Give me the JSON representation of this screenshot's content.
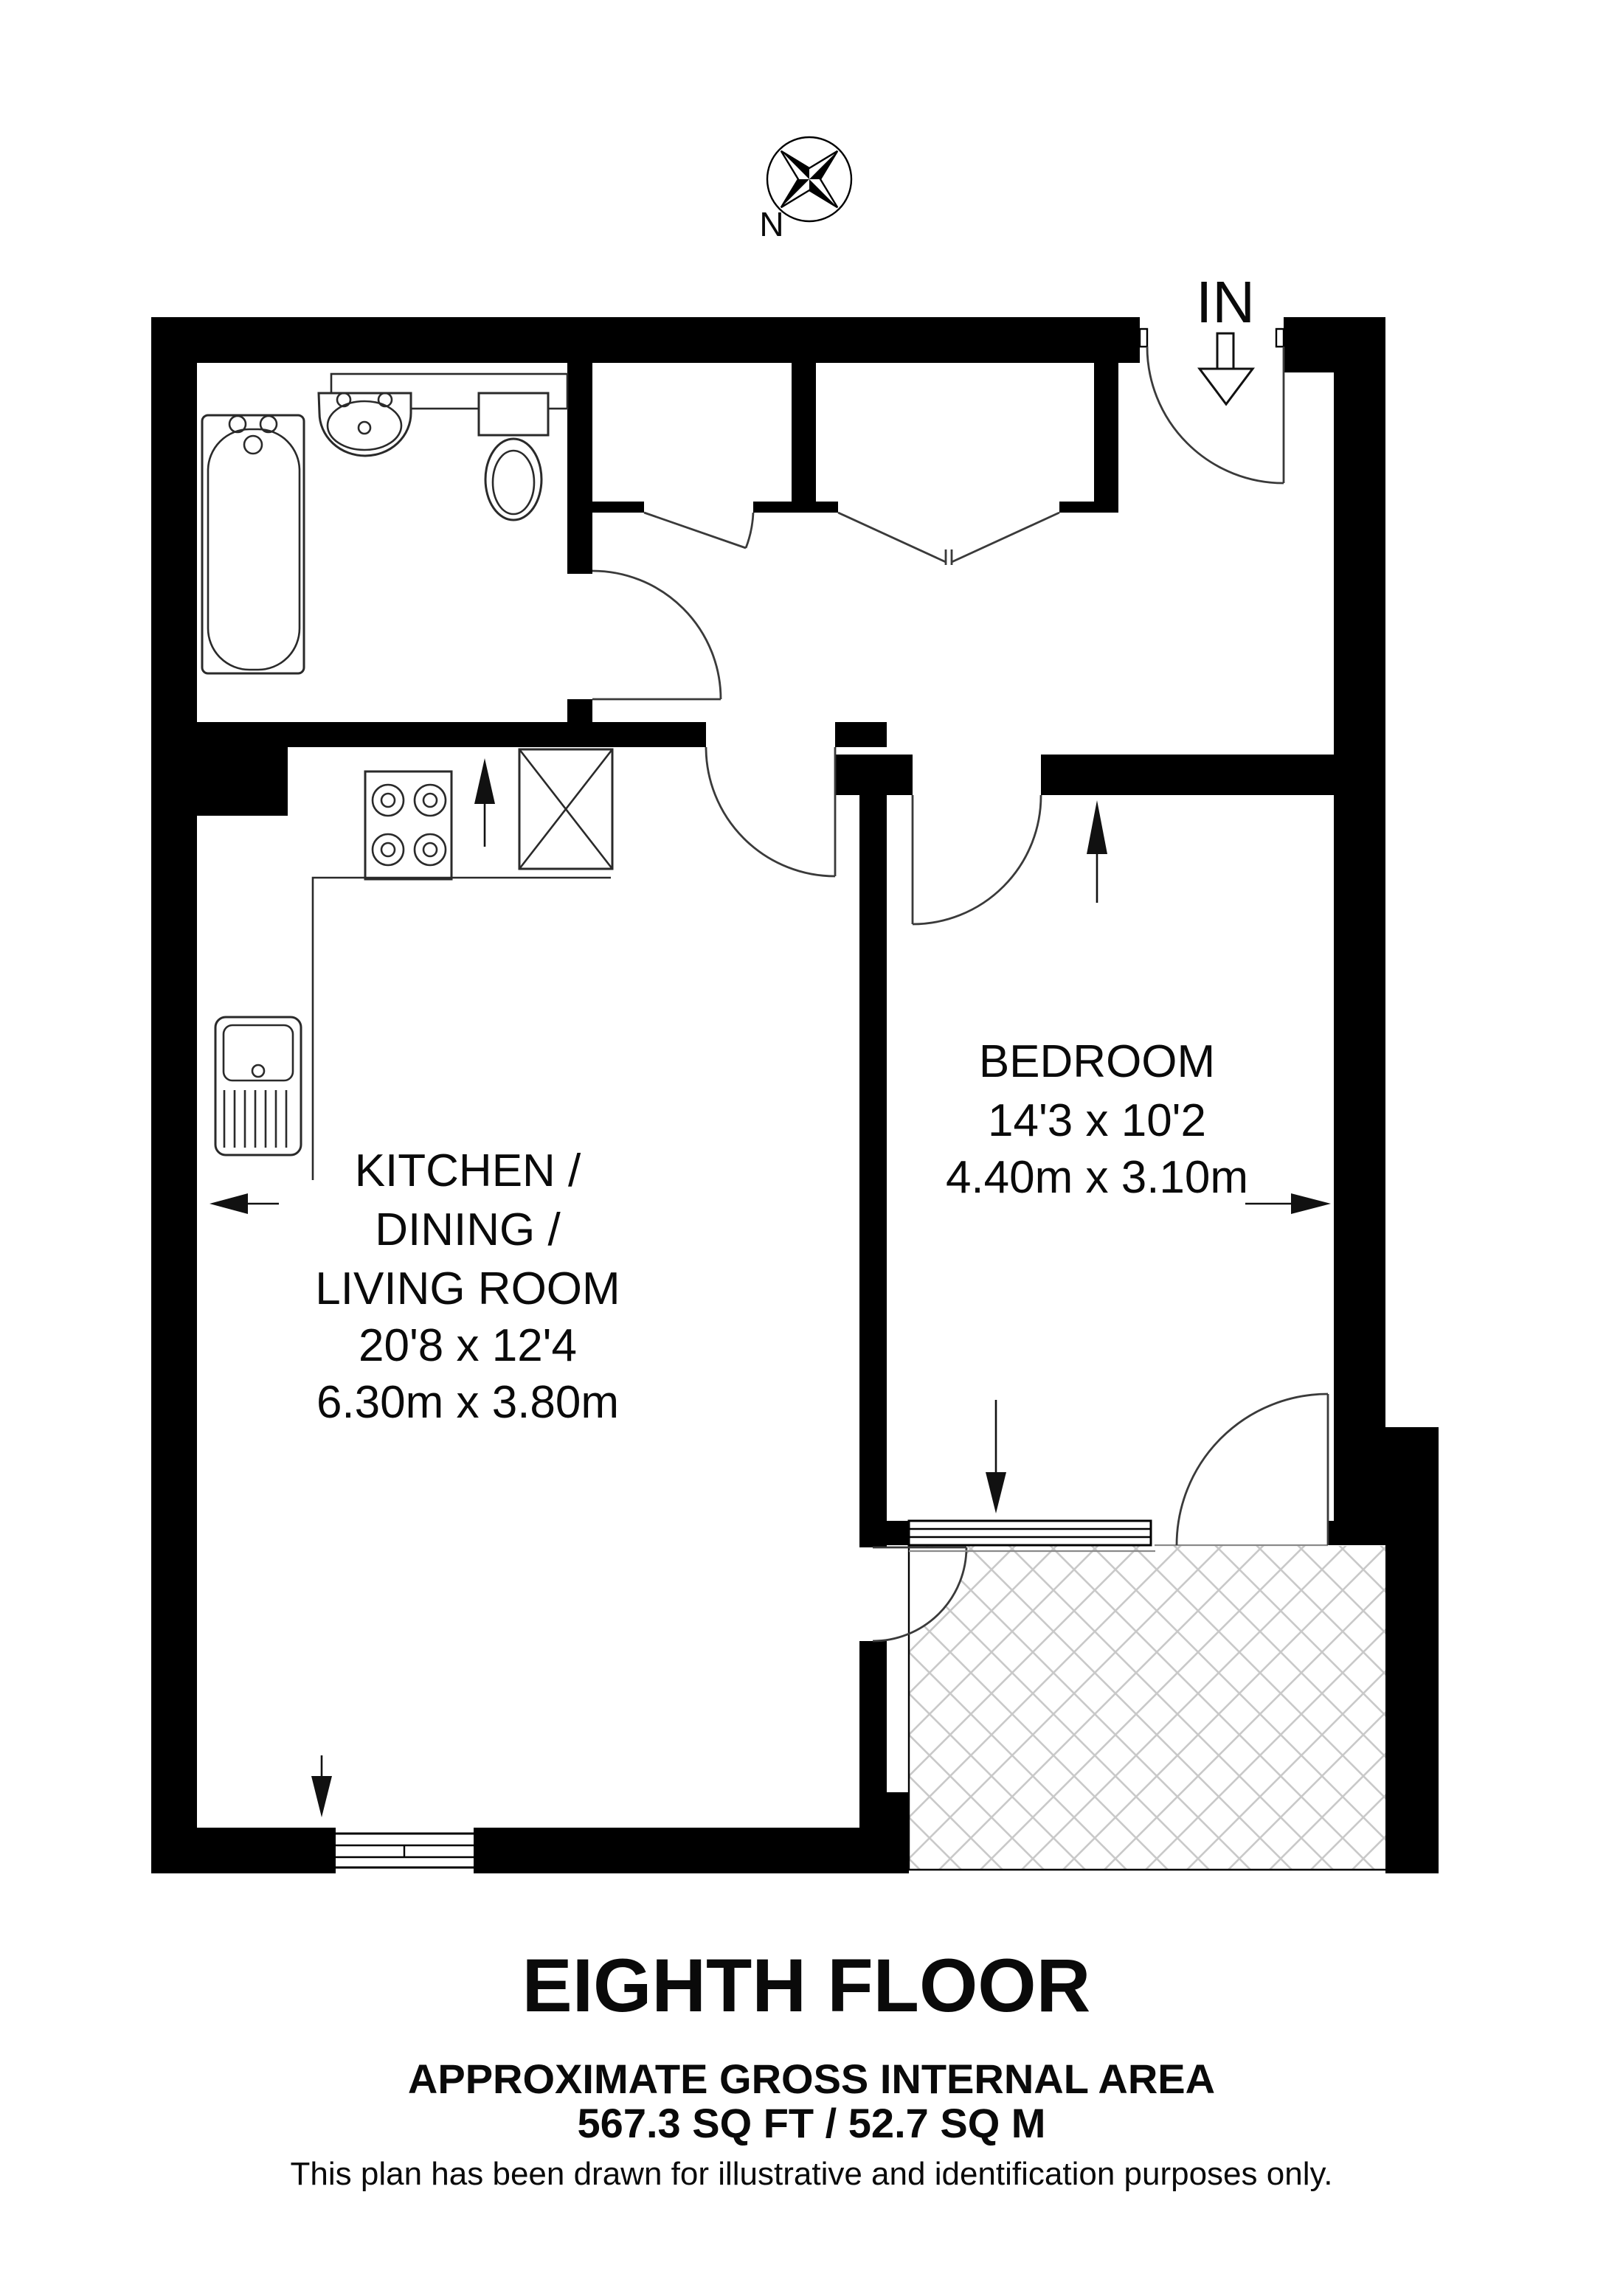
{
  "meta": {
    "background": "#ffffff",
    "wall_color": "#000000",
    "hatch_color": "#c9c9c9"
  },
  "compass": {
    "north_label": "N"
  },
  "entrance": {
    "label": "IN"
  },
  "rooms": {
    "kitchen_living": {
      "name_lines": [
        "KITCHEN /",
        "DINING /",
        "LIVING ROOM"
      ],
      "dims_imperial": "20'8 x 12'4",
      "dims_metric": "6.30m x 3.80m"
    },
    "bedroom": {
      "name": "BEDROOM",
      "dims_imperial": "14'3 x 10'2",
      "dims_metric": "4.40m x 3.10m"
    }
  },
  "footer": {
    "floor_title": "EIGHTH FLOOR",
    "area_heading": "APPROXIMATE GROSS INTERNAL AREA",
    "area_value": "567.3 SQ FT / 52.7 SQ M",
    "disclaimer": "This plan has been drawn for illustrative and identification purposes only."
  }
}
